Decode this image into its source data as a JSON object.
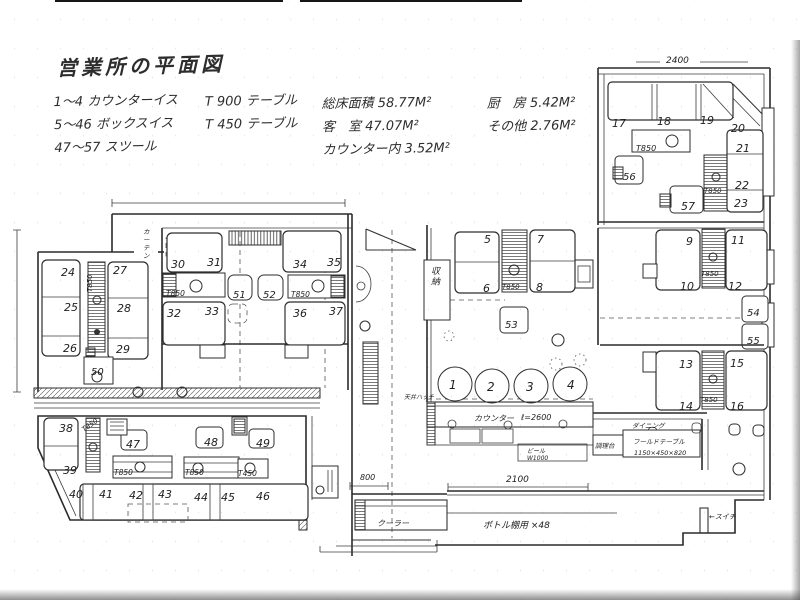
{
  "header": {
    "title": "営業所の平面図",
    "legend_seats": [
      "1〜4 カウンターイス",
      "5〜46 ボックスイス",
      "47〜57 スツール"
    ],
    "legend_tables": [
      "T 900 テーブル",
      "T 450 テーブル"
    ],
    "areas_col1": [
      "総床面積 58.77M²",
      "客　室 47.07M²",
      "カウンター内 3.52M²"
    ],
    "areas_col2": [
      "厨　房 5.42M²",
      "その他 2.76M²"
    ]
  },
  "plan": {
    "labels": [
      {
        "t": "1",
        "x": 449,
        "y": 389,
        "s": 12,
        "n": "seat-label-1"
      },
      {
        "t": "2",
        "x": 487,
        "y": 391,
        "s": 12,
        "n": "seat-label-2"
      },
      {
        "t": "3",
        "x": 526,
        "y": 391,
        "s": 12,
        "n": "seat-label-3"
      },
      {
        "t": "4",
        "x": 567,
        "y": 389,
        "s": 12,
        "n": "seat-label-4"
      },
      {
        "t": "5",
        "x": 484,
        "y": 243,
        "s": 11,
        "n": "seat-label-5"
      },
      {
        "t": "6",
        "x": 483,
        "y": 292,
        "s": 11,
        "n": "seat-label-6"
      },
      {
        "t": "7",
        "x": 537,
        "y": 243,
        "s": 11,
        "n": "seat-label-7"
      },
      {
        "t": "8",
        "x": 536,
        "y": 291,
        "s": 11,
        "n": "seat-label-8"
      },
      {
        "t": "9",
        "x": 686,
        "y": 245,
        "s": 11,
        "n": "seat-label-9"
      },
      {
        "t": "10",
        "x": 680,
        "y": 290,
        "s": 11,
        "n": "seat-label-10"
      },
      {
        "t": "11",
        "x": 731,
        "y": 244,
        "s": 11,
        "n": "seat-label-11"
      },
      {
        "t": "12",
        "x": 728,
        "y": 290,
        "s": 11,
        "n": "seat-label-12"
      },
      {
        "t": "13",
        "x": 679,
        "y": 368,
        "s": 11,
        "n": "seat-label-13"
      },
      {
        "t": "14",
        "x": 679,
        "y": 410,
        "s": 11,
        "n": "seat-label-14"
      },
      {
        "t": "15",
        "x": 730,
        "y": 367,
        "s": 11,
        "n": "seat-label-15"
      },
      {
        "t": "16",
        "x": 730,
        "y": 410,
        "s": 11,
        "n": "seat-label-16"
      },
      {
        "t": "17",
        "x": 612,
        "y": 127,
        "s": 11,
        "n": "seat-label-17"
      },
      {
        "t": "18",
        "x": 657,
        "y": 125,
        "s": 11,
        "n": "seat-label-18"
      },
      {
        "t": "19",
        "x": 700,
        "y": 124,
        "s": 11,
        "n": "seat-label-19"
      },
      {
        "t": "20",
        "x": 731,
        "y": 132,
        "s": 11,
        "n": "seat-label-20"
      },
      {
        "t": "21",
        "x": 736,
        "y": 152,
        "s": 11,
        "n": "seat-label-21"
      },
      {
        "t": "22",
        "x": 735,
        "y": 189,
        "s": 11,
        "n": "seat-label-22"
      },
      {
        "t": "23",
        "x": 734,
        "y": 207,
        "s": 11,
        "n": "seat-label-23"
      },
      {
        "t": "24",
        "x": 61,
        "y": 276,
        "s": 11,
        "n": "seat-label-24"
      },
      {
        "t": "25",
        "x": 64,
        "y": 311,
        "s": 11,
        "n": "seat-label-25"
      },
      {
        "t": "26",
        "x": 63,
        "y": 352,
        "s": 11,
        "n": "seat-label-26"
      },
      {
        "t": "27",
        "x": 113,
        "y": 274,
        "s": 11,
        "n": "seat-label-27"
      },
      {
        "t": "28",
        "x": 117,
        "y": 312,
        "s": 11,
        "n": "seat-label-28"
      },
      {
        "t": "29",
        "x": 116,
        "y": 353,
        "s": 11,
        "n": "seat-label-29"
      },
      {
        "t": "30",
        "x": 171,
        "y": 268,
        "s": 11,
        "n": "seat-label-30"
      },
      {
        "t": "31",
        "x": 207,
        "y": 266,
        "s": 11,
        "n": "seat-label-31"
      },
      {
        "t": "32",
        "x": 167,
        "y": 317,
        "s": 11,
        "n": "seat-label-32"
      },
      {
        "t": "33",
        "x": 205,
        "y": 315,
        "s": 11,
        "n": "seat-label-33"
      },
      {
        "t": "34",
        "x": 293,
        "y": 268,
        "s": 11,
        "n": "seat-label-34"
      },
      {
        "t": "35",
        "x": 327,
        "y": 266,
        "s": 11,
        "n": "seat-label-35"
      },
      {
        "t": "36",
        "x": 293,
        "y": 317,
        "s": 11,
        "n": "seat-label-36"
      },
      {
        "t": "37",
        "x": 329,
        "y": 315,
        "s": 11,
        "n": "seat-label-37"
      },
      {
        "t": "38",
        "x": 59,
        "y": 432,
        "s": 11,
        "n": "seat-label-38"
      },
      {
        "t": "39",
        "x": 63,
        "y": 474,
        "s": 11,
        "n": "seat-label-39"
      },
      {
        "t": "40",
        "x": 69,
        "y": 498,
        "s": 11,
        "n": "seat-label-40"
      },
      {
        "t": "41",
        "x": 99,
        "y": 498,
        "s": 11,
        "n": "seat-label-41"
      },
      {
        "t": "42",
        "x": 129,
        "y": 499,
        "s": 11,
        "n": "seat-label-42"
      },
      {
        "t": "43",
        "x": 158,
        "y": 498,
        "s": 11,
        "n": "seat-label-43"
      },
      {
        "t": "44",
        "x": 194,
        "y": 501,
        "s": 11,
        "n": "seat-label-44"
      },
      {
        "t": "45",
        "x": 221,
        "y": 501,
        "s": 11,
        "n": "seat-label-45"
      },
      {
        "t": "46",
        "x": 256,
        "y": 500,
        "s": 11,
        "n": "seat-label-46"
      },
      {
        "t": "47",
        "x": 126,
        "y": 448,
        "s": 11,
        "n": "seat-label-47"
      },
      {
        "t": "48",
        "x": 204,
        "y": 446,
        "s": 11,
        "n": "seat-label-48"
      },
      {
        "t": "49",
        "x": 256,
        "y": 447,
        "s": 11,
        "n": "seat-label-49"
      },
      {
        "t": "50",
        "x": 91,
        "y": 375,
        "s": 10,
        "n": "seat-label-50"
      },
      {
        "t": "51",
        "x": 233,
        "y": 298,
        "s": 10,
        "n": "seat-label-51"
      },
      {
        "t": "52",
        "x": 263,
        "y": 298,
        "s": 10,
        "n": "seat-label-52"
      },
      {
        "t": "53",
        "x": 505,
        "y": 328,
        "s": 10,
        "n": "seat-label-53"
      },
      {
        "t": "54",
        "x": 747,
        "y": 316,
        "s": 10,
        "n": "seat-label-54"
      },
      {
        "t": "55",
        "x": 747,
        "y": 344,
        "s": 10,
        "n": "seat-label-55"
      },
      {
        "t": "56",
        "x": 623,
        "y": 180,
        "s": 10,
        "n": "seat-label-56"
      },
      {
        "t": "57",
        "x": 681,
        "y": 210,
        "s": 11,
        "n": "seat-label-57"
      },
      {
        "t": "T850",
        "x": 636,
        "y": 151,
        "s": 8,
        "n": "table-label"
      },
      {
        "t": "T850",
        "x": 704,
        "y": 193,
        "s": 7,
        "n": "table-label"
      },
      {
        "t": "T850",
        "x": 701,
        "y": 276,
        "s": 7,
        "n": "table-label"
      },
      {
        "t": "T850",
        "x": 700,
        "y": 402,
        "s": 7,
        "n": "table-label"
      },
      {
        "t": "T850",
        "x": 502,
        "y": 289,
        "s": 7,
        "n": "table-label"
      },
      {
        "t": "T850",
        "x": 166,
        "y": 296,
        "s": 7.5,
        "n": "table-label"
      },
      {
        "t": "T850",
        "x": 291,
        "y": 297,
        "s": 7.5,
        "n": "table-label"
      },
      {
        "t": "T850",
        "x": 92,
        "y": 292,
        "s": 7,
        "r": -90,
        "n": "table-label"
      },
      {
        "t": "T850",
        "x": 114,
        "y": 475,
        "s": 7.5,
        "n": "table-label"
      },
      {
        "t": "T850",
        "x": 185,
        "y": 475,
        "s": 7.5,
        "n": "table-label"
      },
      {
        "t": "T450",
        "x": 238,
        "y": 476,
        "s": 7.5,
        "n": "table-label"
      },
      {
        "t": "T850",
        "x": 84,
        "y": 432,
        "s": 7,
        "r": -35,
        "n": "table-label"
      },
      {
        "t": "2400",
        "x": 666,
        "y": 63,
        "s": 9,
        "n": "dim-2400"
      },
      {
        "t": "収納",
        "x": 431,
        "y": 274,
        "s": 9,
        "v": 1,
        "n": "storage-label"
      },
      {
        "t": "カーテン",
        "x": 143,
        "y": 234,
        "s": 6.5,
        "v": 1,
        "n": "curtain-label"
      },
      {
        "t": "カウンター",
        "x": 474,
        "y": 421,
        "s": 8,
        "n": "counter-label"
      },
      {
        "t": "ℓ=2600",
        "x": 521,
        "y": 420,
        "s": 8,
        "n": "counter-length-label"
      },
      {
        "t": "ビール",
        "x": 527,
        "y": 453,
        "s": 6,
        "n": "beer-label"
      },
      {
        "t": "W1000",
        "x": 527,
        "y": 460,
        "s": 6,
        "n": "beer-width-label"
      },
      {
        "t": "2100",
        "x": 506,
        "y": 482,
        "s": 9,
        "n": "dim-2100"
      },
      {
        "t": "800",
        "x": 360,
        "y": 480,
        "s": 8,
        "n": "dim-800"
      },
      {
        "t": "クーラー",
        "x": 377,
        "y": 526,
        "s": 8,
        "n": "cooler-label"
      },
      {
        "t": "ボトル棚用 ×48",
        "x": 483,
        "y": 528,
        "s": 9,
        "n": "bottle-shelf-label"
      },
      {
        "t": "ダイニング",
        "x": 632,
        "y": 428,
        "s": 6.5,
        "n": "dining-label"
      },
      {
        "t": "フールドテーブル",
        "x": 633,
        "y": 444,
        "s": 6.5,
        "n": "fold-table-label"
      },
      {
        "t": "1150×450×820",
        "x": 634,
        "y": 455,
        "s": 6.5,
        "n": "fold-table-size-label"
      },
      {
        "t": "調理台",
        "x": 595,
        "y": 448,
        "s": 6.5,
        "n": "prep-table-label"
      },
      {
        "t": "←スイチ",
        "x": 709,
        "y": 519,
        "s": 7,
        "n": "switch-label"
      },
      {
        "t": "天井ハッチ",
        "x": 404,
        "y": 399,
        "s": 6,
        "n": "hatch-label"
      }
    ]
  }
}
